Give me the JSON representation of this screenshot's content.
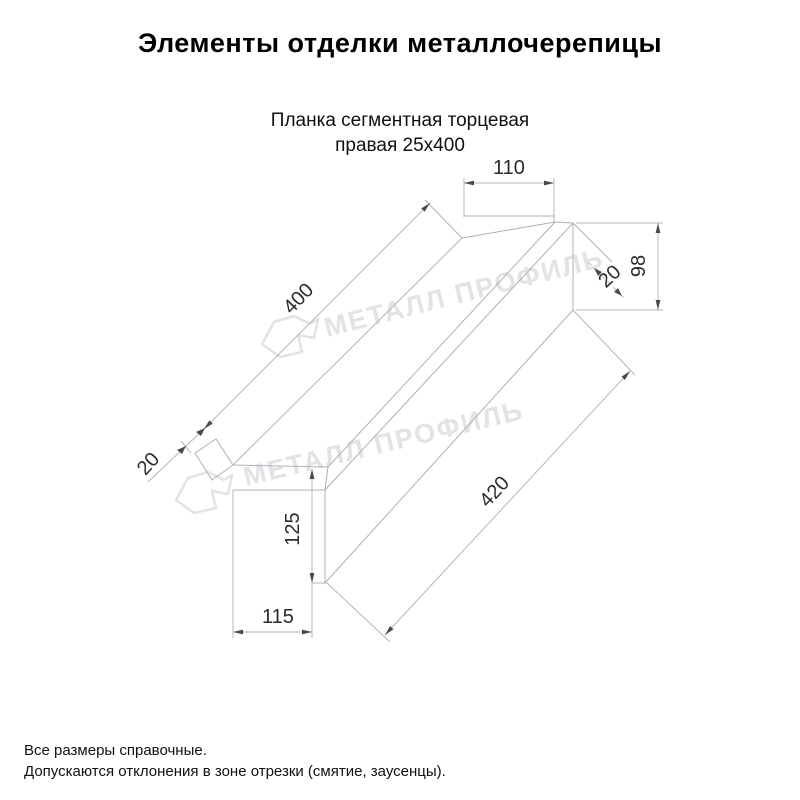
{
  "page": {
    "title": "Элементы отделки металлочерепицы"
  },
  "product": {
    "name_line1": "Планка сегментная торцевая",
    "name_line2": "правая 25х400"
  },
  "dims": {
    "top_width": "110",
    "end_height": "98",
    "fold_right": "20",
    "length_top": "400",
    "fold_left": "20",
    "left_height": "125",
    "bottom_width": "115",
    "length_bottom": "420"
  },
  "watermark": {
    "text": "МЕТАЛЛ ПРОФИЛЬ"
  },
  "footer": {
    "line1": "Все размеры справочные.",
    "line2": "Допускаются отклонения в зоне отрезки (смятие, заусенцы)."
  },
  "colors": {
    "drawing_line": "#adb2b8",
    "dimension_text": "#2b2b2b",
    "arrow": "#4a4a4a",
    "watermark": "#e3e3e7",
    "background": "#ffffff"
  }
}
